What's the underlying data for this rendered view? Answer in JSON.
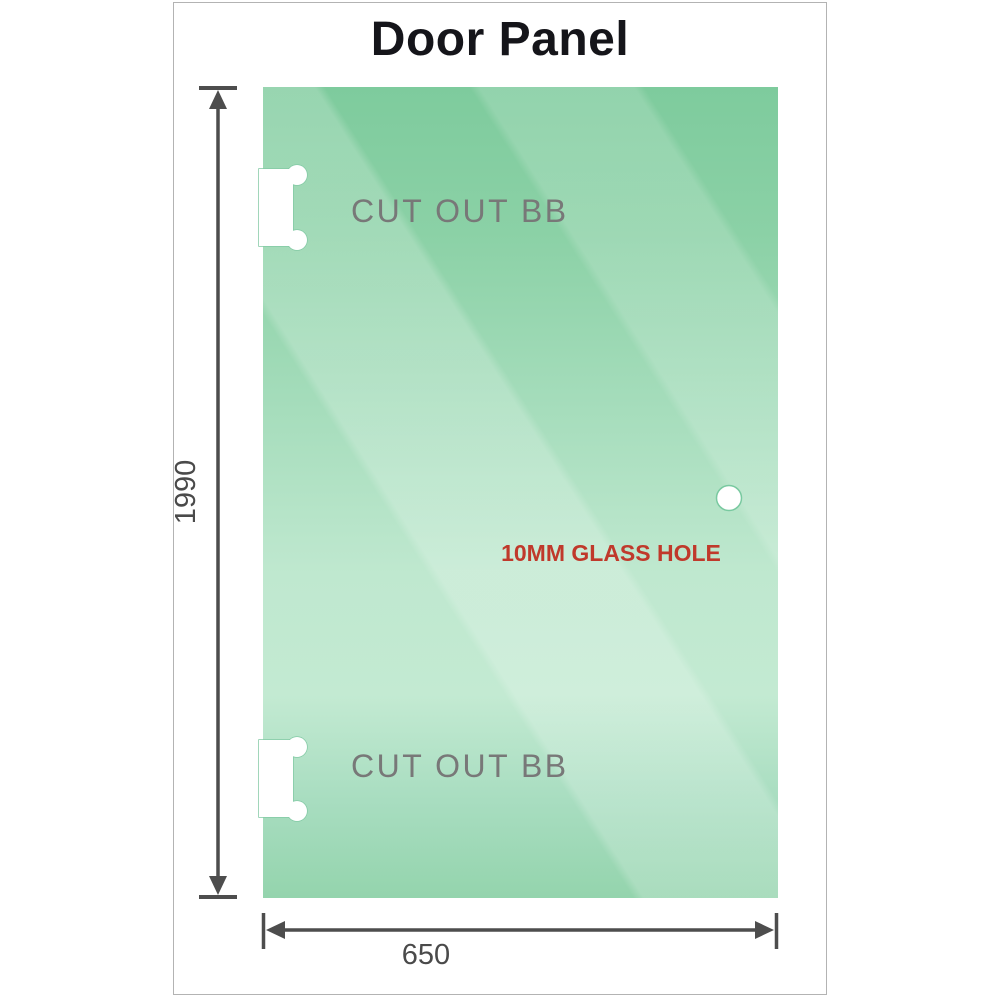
{
  "title": "Door Panel",
  "panel": {
    "cutouts": [
      {
        "label": "CUT OUT BB"
      },
      {
        "label": "CUT OUT BB"
      }
    ],
    "hole": {
      "label": "10MM GLASS HOLE",
      "label_color": "#c0392b"
    }
  },
  "dimensions": {
    "height": "1990",
    "width": "650"
  },
  "colors": {
    "glass_top": "#7ecb9d",
    "glass_light": "#c3ead2",
    "glass_bottom": "#94d4ad",
    "dimension_lines": "#4d4d4d",
    "cutout_text": "#787878",
    "frame_border": "#b3b3b3",
    "title_text": "#15151a"
  }
}
